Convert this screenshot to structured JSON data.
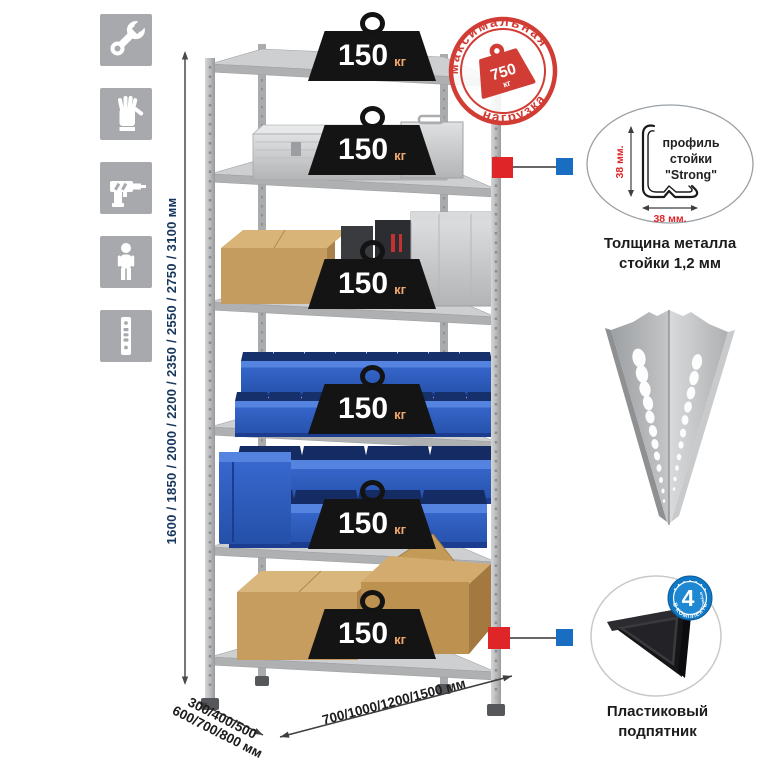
{
  "sidebar": {
    "icons": [
      {
        "name": "wrench"
      },
      {
        "name": "gloves"
      },
      {
        "name": "drill"
      },
      {
        "name": "person"
      },
      {
        "name": "post-profile"
      }
    ]
  },
  "height_dim": {
    "label": "1600 / 1850 / 2000 / 2200 / 2350 / 2550 / 2750 / 3100 мм"
  },
  "rack": {
    "weights": [
      {
        "value": "150",
        "unit": "кг"
      },
      {
        "value": "150",
        "unit": "кг"
      },
      {
        "value": "150",
        "unit": "кг"
      },
      {
        "value": "150",
        "unit": "кг"
      },
      {
        "value": "150",
        "unit": "кг"
      },
      {
        "value": "150",
        "unit": "кг"
      }
    ]
  },
  "stamp": {
    "arc_top": "максимальная",
    "arc_bottom": "нагрузка",
    "value": "750",
    "unit": "кг"
  },
  "profile": {
    "line1": "профиль",
    "line2": "стойки",
    "line3": "\"Strong\"",
    "dim_v": "38 мм.",
    "dim_h": "38 мм.",
    "caption1": "Толщина металла",
    "caption2": "стойки 1,2 мм"
  },
  "foot": {
    "badge_value": "4",
    "badge_note": "штуки",
    "badge_arc": "в комплекте",
    "caption1": "Пластиковый",
    "caption2": "подпятник"
  },
  "dims": {
    "depth1": "300/400/500",
    "depth2": "600/700/800 мм",
    "width": "700/1000/1200/1500 мм"
  },
  "colors": {
    "accent_red": "#d13c34",
    "marker_red": "#e02528",
    "marker_blue": "#1a6ec2",
    "badge_blue": "#1079c6",
    "dim_text": "#17365d"
  }
}
